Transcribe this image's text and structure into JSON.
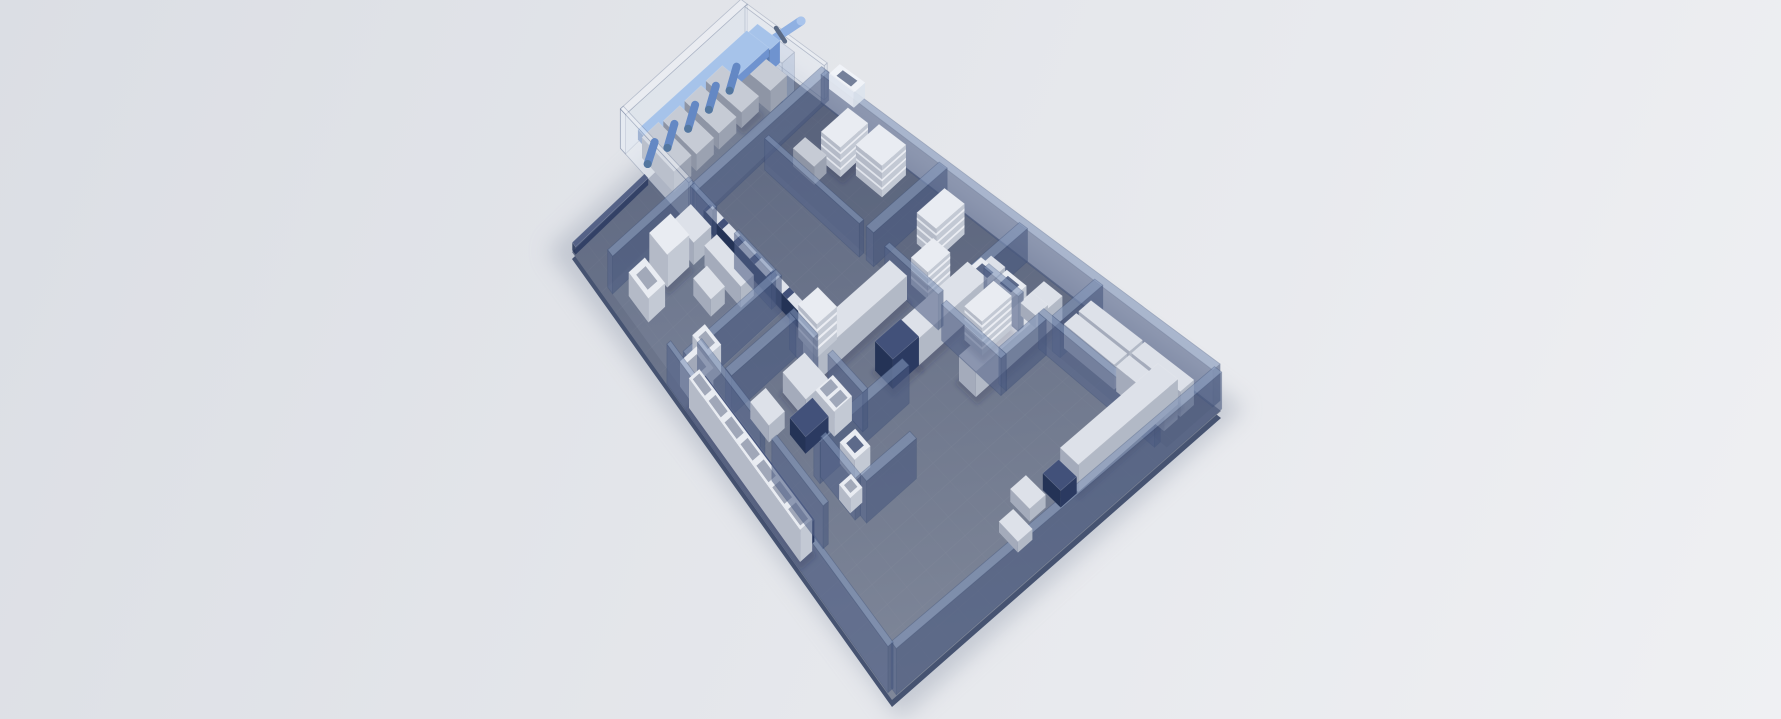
{
  "meta": {
    "scene_type": "isometric-3d-facility-floorplan-render",
    "description": "Bird's-eye 3D rendering of a laboratory / production facility floor plan with glass partition walls, white benches, shelving units and a blue exhaust duct system, on a plain light grey backdrop. No text or UI controls are visible."
  },
  "colors": {
    "backdrop_top": "#dbdee4",
    "backdrop_bottom": "#eff0f3",
    "floor_far": "#5d6780",
    "floor_near": "#7f8799",
    "floor_slab": "#465371",
    "ambient_shadow": "#a3aab9",
    "grid_line": "#ffffff",
    "wall_frame": "#31466f",
    "navy_accent": "#2b3a61",
    "duct_blue": "#6f93cf",
    "furniture_top": "#dde1e9",
    "object_shadow": "#1c2747"
  },
  "scene": {
    "corners": {
      "c00": [
        770,
        62
      ],
      "c10": [
        1221,
        411
      ],
      "c01": [
        572,
        252
      ],
      "c11": [
        892,
        700
      ]
    },
    "palettes": {
      "W": [
        "#dde1e9",
        "#b2b9c6",
        "#a4abbb"
      ],
      "Wb": [
        "#e9ecf2",
        "#c3c9d4",
        "#b4bac7"
      ],
      "M": [
        "#c6cbd5",
        "#9ba2b1",
        "#8e95a5"
      ],
      "N": [
        "#42517a",
        "#2b3a61",
        "#243356"
      ],
      "D": [
        "#a6c3ea",
        "#6f93cf",
        "#5a7cb2"
      ],
      "G": [
        "#8296ba",
        "#49597f",
        "#55648a"
      ],
      "GW": [
        "#f2f5fa",
        "#dde4ee",
        "#e7ecf4"
      ],
      "GC": [
        "#c7d3e6",
        "#9fb2d2",
        "#aebfdd"
      ]
    },
    "objects": [
      {
        "n": "room-tint-enclosure",
        "t": "tint",
        "u": -0.075,
        "v": -0.025,
        "du": 0.19,
        "dv": 0.64,
        "c": "#eef2f8",
        "o": 0.15
      },
      {
        "n": "room-tint-top-rooms",
        "t": "tint",
        "u": 0.115,
        "v": 0,
        "du": 0.44,
        "dv": 0.285,
        "c": "#16213f",
        "o": 0.09
      },
      {
        "n": "room-tint-right-rooms",
        "t": "tint",
        "u": 0.555,
        "v": 0,
        "du": 0.43,
        "dv": 0.145,
        "c": "#16213f",
        "o": 0.09
      },
      {
        "n": "room-tint-west-room",
        "t": "tint",
        "u": 0.092,
        "v": 0.585,
        "du": 0.25,
        "dv": 0.385,
        "c": "#e8eef8",
        "o": 0.07
      },
      {
        "n": "glass-enclosure-back-wall",
        "t": "wall",
        "u": -0.075,
        "v": -0.025,
        "du": 0.014,
        "dv": 0.64,
        "h": 46,
        "pal": "GW",
        "o": 0.5
      },
      {
        "n": "glass-enclosure-top-wall",
        "t": "wall",
        "u": -0.06,
        "v": -0.025,
        "du": 0.175,
        "dv": 0.014,
        "h": 46,
        "pal": "GW",
        "o": 0.45
      },
      {
        "n": "glass-enclosure-end-wall",
        "t": "wall",
        "u": -0.075,
        "v": 0.6,
        "du": 0.185,
        "dv": 0.016,
        "h": 46,
        "pal": "GW",
        "o": 0.5
      },
      {
        "n": "lab-machine",
        "t": "box",
        "u": -0.035,
        "v": 0.165,
        "du": 0.085,
        "dv": 0.085,
        "h": 20,
        "pal": "M",
        "sh": 1
      },
      {
        "n": "lab-machine",
        "t": "box",
        "u": -0.035,
        "v": 0.275,
        "du": 0.085,
        "dv": 0.085,
        "h": 20,
        "pal": "M"
      },
      {
        "n": "lab-machine",
        "t": "box",
        "u": -0.035,
        "v": 0.385,
        "du": 0.085,
        "dv": 0.085,
        "h": 20,
        "pal": "M"
      },
      {
        "n": "lab-machine",
        "t": "box",
        "u": -0.035,
        "v": 0.495,
        "du": 0.085,
        "dv": 0.085,
        "h": 24,
        "pal": "M"
      },
      {
        "n": "duct-inlet-machine",
        "t": "box",
        "u": -0.005,
        "v": 0.06,
        "du": 0.07,
        "dv": 0.08,
        "h": 28,
        "pal": "M"
      },
      {
        "n": "exhaust-duct-run",
        "t": "box",
        "u": -0.028,
        "v": 0.055,
        "du": 0.05,
        "dv": 0.56,
        "h": 12,
        "z": 32,
        "pal": "D",
        "dbias": 0.05
      },
      {
        "n": "duct-branch-drop",
        "t": "drop",
        "u": -0.004,
        "v": 0.16,
        "z": 32,
        "len": 24,
        "w": 8,
        "c": "#6488c4",
        "dbias": 0.06
      },
      {
        "n": "duct-branch-drop",
        "t": "drop",
        "u": -0.004,
        "v": 0.265,
        "z": 32,
        "len": 24,
        "w": 8,
        "c": "#6488c4",
        "dbias": 0.06
      },
      {
        "n": "duct-branch-drop",
        "t": "drop",
        "u": -0.004,
        "v": 0.37,
        "z": 32,
        "len": 24,
        "w": 8,
        "c": "#6488c4",
        "dbias": 0.06
      },
      {
        "n": "duct-branch-drop",
        "t": "drop",
        "u": -0.004,
        "v": 0.475,
        "z": 32,
        "len": 24,
        "w": 8,
        "c": "#6488c4",
        "dbias": 0.06
      },
      {
        "n": "duct-branch-drop",
        "t": "drop",
        "u": -0.004,
        "v": 0.575,
        "z": 32,
        "len": 22,
        "w": 8,
        "c": "#6488c4",
        "dbias": 0.06
      },
      {
        "n": "duct-riser",
        "t": "box",
        "u": -0.02,
        "v": 0.018,
        "du": 0.05,
        "dv": 0.05,
        "h": 30,
        "z": 18,
        "pal": "D",
        "dbias": 0.055
      },
      {
        "n": "exhaust-pipe",
        "t": "pipe",
        "x1": 747,
        "y1": 57,
        "x2": 801,
        "y2": 21,
        "w": 9,
        "c": "#8fb0e2",
        "fc": "#5a6a85",
        "flanges": [
          0.35,
          0.62
        ],
        "depth": 0.02
      },
      {
        "n": "rooftop-vent",
        "t": "box",
        "u": 0.13,
        "v": -0.052,
        "du": 0.055,
        "dv": 0.05,
        "h": 20,
        "z": 24,
        "pal": "GW",
        "o": 0.9,
        "inset": "#5a6886",
        "dbias": 0.06
      },
      {
        "n": "glass-column",
        "t": "wall",
        "u": 0.022,
        "v": 0.028,
        "du": 0.045,
        "dv": 0.06,
        "h": 52,
        "pal": "GC",
        "o": 0.4
      },
      {
        "n": "wall-ne-perimeter",
        "t": "wall",
        "u": 0.115,
        "v": -0.018,
        "du": 0.87,
        "dv": 0.022,
        "h": 38,
        "pal": "G",
        "o": 0.6
      },
      {
        "n": "wall-se-perimeter",
        "t": "wall",
        "u": 0.982,
        "v": -0.005,
        "du": 0.016,
        "dv": 0.99,
        "h": 38,
        "pal": "G",
        "o": 0.6
      },
      {
        "n": "wall-sw-perimeter",
        "t": "wall",
        "u": 0.295,
        "v": 0.982,
        "du": 0.69,
        "dv": 0.016,
        "h": 38,
        "pal": "G",
        "o": 0.62
      },
      {
        "n": "plinth-nw-edge",
        "t": "box",
        "u": -0.002,
        "v": 0.63,
        "du": 0.01,
        "dv": 0.365,
        "h": 8,
        "pal": "N",
        "o": 0.85
      },
      {
        "n": "wall-room",
        "t": "wall",
        "u": 0.105,
        "v": -0.02,
        "du": 0.016,
        "dv": 0.62,
        "h": 38
      },
      {
        "n": "wall-room",
        "t": "wall",
        "u": 0.375,
        "v": 0,
        "du": 0.018,
        "dv": 0.295,
        "h": 38
      },
      {
        "n": "wall-room",
        "t": "wall",
        "u": 0.553,
        "v": 0,
        "du": 0.018,
        "dv": 0.345,
        "h": 38
      },
      {
        "n": "wall-room",
        "t": "wall",
        "u": 0.133,
        "v": 0.285,
        "du": 0.23,
        "dv": 0.018,
        "h": 38
      },
      {
        "n": "wall-room",
        "t": "wall",
        "u": 0.425,
        "v": 0.285,
        "du": 0.13,
        "dv": 0.018,
        "h": 38
      },
      {
        "n": "wall-room",
        "t": "wall",
        "u": 0.72,
        "v": 0,
        "du": 0.018,
        "dv": 0.145,
        "h": 38
      },
      {
        "n": "wall-room",
        "t": "wall",
        "u": 0.573,
        "v": 0.145,
        "du": 0.08,
        "dv": 0.018,
        "h": 38
      },
      {
        "n": "wall-room",
        "t": "wall",
        "u": 0.7,
        "v": 0.145,
        "du": 0.27,
        "dv": 0.018,
        "h": 38
      },
      {
        "n": "wall-room",
        "t": "wall",
        "u": 0.7,
        "v": 0.163,
        "du": 0.018,
        "dv": 0.137,
        "h": 38
      },
      {
        "n": "wall-room",
        "t": "wall",
        "u": 0.573,
        "v": 0.3,
        "du": 0.145,
        "dv": 0.018,
        "h": 38
      },
      {
        "n": "wall-room",
        "t": "wall",
        "u": 0.092,
        "v": 0.585,
        "du": 0.015,
        "dv": 0.385,
        "h": 38
      },
      {
        "n": "wall-room",
        "t": "wall",
        "u": 0.325,
        "v": 0.585,
        "du": 0.015,
        "dv": 0.385,
        "h": 38
      },
      {
        "n": "wall-room",
        "t": "wall",
        "u": 0.107,
        "v": 0.585,
        "du": 0.06,
        "dv": 0.018,
        "h": 38
      },
      {
        "n": "wall-room",
        "t": "wall",
        "u": 0.225,
        "v": 0.585,
        "du": 0.1,
        "dv": 0.018,
        "h": 38
      },
      {
        "n": "wall-room",
        "t": "wall",
        "u": 0.4,
        "v": 0.625,
        "du": 0.065,
        "dv": 0.018,
        "h": 38
      },
      {
        "n": "wall-room",
        "t": "wall",
        "u": 0.505,
        "v": 0.625,
        "du": 0.095,
        "dv": 0.018,
        "h": 38
      },
      {
        "n": "wall-room",
        "t": "wall",
        "u": 0.6,
        "v": 0.5,
        "du": 0.018,
        "dv": 0.32,
        "h": 38
      },
      {
        "n": "wall-room",
        "t": "wall",
        "u": 0.4,
        "v": 0.643,
        "du": 0.018,
        "dv": 0.255,
        "h": 38
      },
      {
        "n": "wall-room",
        "t": "wall",
        "u": 0.61,
        "v": 0.79,
        "du": 0.1,
        "dv": 0.018,
        "h": 38
      },
      {
        "n": "wall-room",
        "t": "wall",
        "u": 0.71,
        "v": 0.62,
        "du": 0.018,
        "dv": 0.17,
        "h": 38
      },
      {
        "n": "wall-corridor",
        "t": "wall",
        "u": 0.33,
        "v": 0.9,
        "du": 0.19,
        "dv": 0.018,
        "h": 38
      },
      {
        "n": "wall-corridor",
        "t": "wall",
        "u": 0.555,
        "v": 0.9,
        "du": 0.155,
        "dv": 0.018,
        "h": 38
      },
      {
        "n": "shelf-unit",
        "t": "box",
        "u": 0.19,
        "v": 0.035,
        "du": 0.045,
        "dv": 0.12,
        "h": 36,
        "pal": "Wb",
        "stripes": 3,
        "sh": 1
      },
      {
        "n": "shelf-unit",
        "t": "box",
        "u": 0.252,
        "v": 0.02,
        "du": 0.06,
        "dv": 0.1,
        "h": 38,
        "pal": "Wb",
        "stripes": 3
      },
      {
        "n": "cabinet",
        "t": "box",
        "u": 0.163,
        "v": 0.175,
        "du": 0.05,
        "dv": 0.055,
        "h": 22,
        "pal": "M"
      },
      {
        "n": "shelf-unit",
        "t": "box",
        "u": 0.415,
        "v": 0.05,
        "du": 0.045,
        "dv": 0.11,
        "h": 36,
        "pal": "Wb",
        "stripes": 3
      },
      {
        "n": "shelf-unit",
        "t": "box",
        "u": 0.462,
        "v": 0.175,
        "du": 0.04,
        "dv": 0.085,
        "h": 30,
        "pal": "Wb",
        "stripes": 3
      },
      {
        "n": "shelf-unit",
        "t": "box",
        "u": 0.6,
        "v": 0.17,
        "du": 0.042,
        "dv": 0.105,
        "h": 36,
        "pal": "Wb",
        "stripes": 4,
        "sh": 1
      },
      {
        "n": "bench-row",
        "t": "box",
        "u": 0.73,
        "v": 0.028,
        "du": 0.115,
        "dv": 0.042,
        "h": 26,
        "pal": "W",
        "sh": 1
      },
      {
        "n": "bench-row",
        "t": "box",
        "u": 0.85,
        "v": 0.028,
        "du": 0.11,
        "dv": 0.042,
        "h": 26,
        "pal": "W"
      },
      {
        "n": "bench-row",
        "t": "box",
        "u": 0.73,
        "v": 0.078,
        "du": 0.115,
        "dv": 0.042,
        "h": 26,
        "pal": "W"
      },
      {
        "n": "bench-row",
        "t": "box",
        "u": 0.85,
        "v": 0.078,
        "du": 0.11,
        "dv": 0.042,
        "h": 26,
        "pal": "W"
      },
      {
        "n": "tall-cabinet",
        "t": "box",
        "u": 0.115,
        "v": 0.71,
        "du": 0.052,
        "dv": 0.1,
        "h": 34,
        "pal": "Wb",
        "sh": 1
      },
      {
        "n": "cabinet",
        "t": "box",
        "u": 0.115,
        "v": 0.615,
        "du": 0.055,
        "dv": 0.08,
        "h": 24,
        "pal": "W"
      },
      {
        "n": "counter",
        "t": "box",
        "u": 0.185,
        "v": 0.615,
        "du": 0.1,
        "dv": 0.055,
        "h": 22,
        "pal": "W"
      },
      {
        "n": "cabinet",
        "t": "box",
        "u": 0.21,
        "v": 0.7,
        "du": 0.05,
        "dv": 0.06,
        "h": 18,
        "pal": "W"
      },
      {
        "n": "cabinet",
        "t": "box",
        "u": 0.13,
        "v": 0.855,
        "du": 0.06,
        "dv": 0.075,
        "h": 24,
        "pal": "Wb",
        "inset": "#9aa2b2"
      },
      {
        "n": "wall-counter-rail",
        "t": "box",
        "u": 0.13,
        "v": 0.552,
        "du": 0.26,
        "dv": 0.03,
        "h": 18,
        "pal": "N",
        "topStripes": 6,
        "sh": 1
      },
      {
        "n": "shelf-unit",
        "t": "box",
        "u": 0.395,
        "v": 0.522,
        "du": 0.05,
        "dv": 0.078,
        "h": 34,
        "pal": "Wb",
        "stripes": 3
      },
      {
        "n": "lab-bench",
        "t": "box",
        "u": 0.435,
        "v": 0.3,
        "du": 0.042,
        "dv": 0.34,
        "h": 26,
        "pal": "W",
        "sh": 1
      },
      {
        "n": "lab-bench",
        "t": "box",
        "u": 0.533,
        "v": 0.16,
        "du": 0.046,
        "dv": 0.25,
        "h": 28,
        "pal": "W",
        "sh": 1
      },
      {
        "n": "bench-cabinet-dark",
        "t": "box",
        "u": 0.533,
        "v": 0.41,
        "du": 0.046,
        "dv": 0.095,
        "h": 30,
        "pal": "N",
        "dbias": 0.01,
        "sh": 1
      },
      {
        "n": "bench-extension",
        "t": "box",
        "u": 0.541,
        "v": 0.085,
        "du": 0.032,
        "dv": 0.075,
        "h": 18,
        "pal": "W"
      },
      {
        "n": "lab-bench",
        "t": "box",
        "u": 0.648,
        "v": 0.065,
        "du": 0.042,
        "dv": 0.3,
        "h": 26,
        "pal": "W",
        "sh": 1
      },
      {
        "n": "fume-hood",
        "t": "box",
        "u": 0.538,
        "v": 0.118,
        "du": 0.045,
        "dv": 0.052,
        "h": 24,
        "pal": "Wb",
        "inset": "#4e5c7e",
        "openFront": 1
      },
      {
        "n": "fume-hood",
        "t": "box",
        "u": 0.586,
        "v": 0.1,
        "du": 0.045,
        "dv": 0.052,
        "h": 24,
        "pal": "Wb",
        "inset": "#4e5c7e",
        "openFront": 1
      },
      {
        "n": "side-table",
        "t": "box",
        "u": 0.635,
        "v": 0.085,
        "du": 0.035,
        "dv": 0.042,
        "h": 14,
        "pal": "W"
      },
      {
        "n": "lab-bench",
        "t": "box",
        "u": 0.895,
        "v": 0.05,
        "du": 0.045,
        "dv": 0.31,
        "h": 26,
        "pal": "W",
        "sh": 1
      },
      {
        "n": "bench-cabinet-dark",
        "t": "box",
        "u": 0.895,
        "v": 0.365,
        "du": 0.045,
        "dv": 0.05,
        "h": 16,
        "pal": "N"
      },
      {
        "n": "side-table",
        "t": "box",
        "u": 0.872,
        "v": 0.44,
        "du": 0.05,
        "dv": 0.05,
        "h": 12,
        "pal": "W"
      },
      {
        "n": "side-table",
        "t": "box",
        "u": 0.9,
        "v": 0.515,
        "du": 0.05,
        "dv": 0.045,
        "h": 10,
        "pal": "W"
      },
      {
        "n": "table",
        "t": "box",
        "u": 0.45,
        "v": 0.655,
        "du": 0.065,
        "dv": 0.085,
        "h": 20,
        "pal": "W",
        "sh": 1
      },
      {
        "n": "sink-cabinet",
        "t": "box",
        "u": 0.52,
        "v": 0.645,
        "du": 0.052,
        "dv": 0.065,
        "h": 24,
        "pal": "Wb",
        "cells": {
          "n": 2,
          "c": "#97a0b2"
        }
      },
      {
        "n": "counter-dark",
        "t": "box",
        "u": 0.515,
        "v": 0.715,
        "du": 0.045,
        "dv": 0.085,
        "h": 16,
        "pal": "N"
      },
      {
        "n": "counter",
        "t": "box",
        "u": 0.445,
        "v": 0.8,
        "du": 0.055,
        "dv": 0.06,
        "h": 16,
        "pal": "W"
      },
      {
        "n": "fume-hood",
        "t": "box",
        "u": 0.615,
        "v": 0.69,
        "du": 0.042,
        "dv": 0.055,
        "h": 20,
        "pal": "Wb",
        "inset": "#4e5c7e"
      },
      {
        "n": "cabinet",
        "t": "box",
        "u": 0.663,
        "v": 0.765,
        "du": 0.032,
        "dv": 0.042,
        "h": 14,
        "pal": "Wb",
        "inset": "#9aa2b2"
      },
      {
        "n": "storage-rail-dark",
        "t": "box",
        "u": 0.36,
        "v": 0.925,
        "du": 0.33,
        "dv": 0.014,
        "h": 20,
        "pal": "N"
      },
      {
        "n": "storage-bin-row",
        "t": "box",
        "u": 0.355,
        "v": 0.944,
        "du": 0.345,
        "dv": 0.042,
        "h": 28,
        "pal": "Wb",
        "cells": {
          "n": 7,
          "c": "#98a0b1"
        },
        "sh": 1
      },
      {
        "n": "cabinet",
        "t": "box",
        "u": 0.3,
        "v": 0.845,
        "du": 0.048,
        "dv": 0.052,
        "h": 28,
        "pal": "Wb",
        "inset": "#9aa2b2"
      },
      {
        "n": "cabinet",
        "t": "box",
        "u": 0.315,
        "v": 0.9,
        "du": 0.05,
        "dv": 0.07,
        "h": 24,
        "pal": "Wb",
        "inset": "#9aa2b2"
      }
    ]
  }
}
